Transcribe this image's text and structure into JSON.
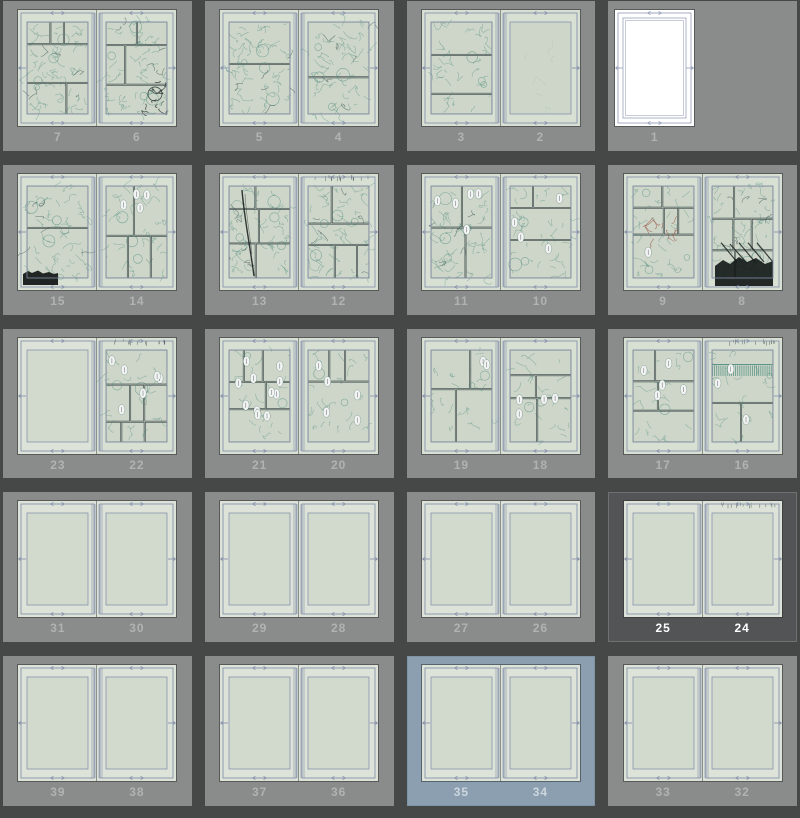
{
  "view": {
    "name": "page-manager-thumbnail-grid",
    "columns": 4,
    "rows": 5
  },
  "colors": {
    "background_gap": "#464848",
    "cell_bg": "#8a8c8c",
    "cell_selected_bg": "#525456",
    "cell_selected_border": "#6e7071",
    "cell_highlight_bg": "#8b9fb1",
    "paper_blank": "#dde3d8",
    "paper_sketch": "#d8e0d3",
    "paper_white": "#ffffff",
    "guide": "#8893ac",
    "guide_white": "#9aa3bd",
    "panel_stroke": "#455052",
    "sketch_teal": "#4b8f81",
    "sketch_dark": "#2f4a4a",
    "ink_black": "#101414",
    "ink_red": "#9b4f3c",
    "fold_line": "#3f4443",
    "page_number": "#b1b3b3",
    "page_number_selected": "#ffffff",
    "page_number_highlight": "#cdd6dd"
  },
  "spreads": [
    {
      "state": "normal",
      "pages": [
        {
          "num": "7",
          "content": "sketch",
          "density": "dense"
        },
        {
          "num": "6",
          "content": "sketch",
          "density": "dense",
          "dark_marks": true
        }
      ]
    },
    {
      "state": "normal",
      "pages": [
        {
          "num": "5",
          "content": "sketch",
          "density": "dense"
        },
        {
          "num": "4",
          "content": "sketch",
          "density": "dense"
        }
      ]
    },
    {
      "state": "normal",
      "pages": [
        {
          "num": "3",
          "content": "sketch",
          "density": "medium"
        },
        {
          "num": "2",
          "content": "sketch",
          "density": "faint"
        }
      ]
    },
    {
      "state": "normal",
      "pages": [
        {
          "num": "1",
          "content": "white"
        }
      ]
    },
    {
      "state": "normal",
      "pages": [
        {
          "num": "15",
          "content": "sketch",
          "density": "dense",
          "black_blob": "bottom-left"
        },
        {
          "num": "14",
          "content": "sketch",
          "density": "medium",
          "balloons": 4
        }
      ]
    },
    {
      "state": "normal",
      "pages": [
        {
          "num": "13",
          "content": "sketch",
          "density": "dense",
          "black_stroke": true
        },
        {
          "num": "12",
          "content": "sketch",
          "density": "dense",
          "top_scribbles": true
        }
      ]
    },
    {
      "state": "normal",
      "pages": [
        {
          "num": "11",
          "content": "sketch",
          "density": "dense",
          "balloons": 5
        },
        {
          "num": "10",
          "content": "sketch",
          "density": "medium",
          "balloons": 4
        }
      ]
    },
    {
      "state": "normal",
      "pages": [
        {
          "num": "9",
          "content": "sketch",
          "density": "medium",
          "red_marks": true,
          "balloons": 1
        },
        {
          "num": "8",
          "content": "sketch",
          "density": "dense",
          "black_blob": "bottom"
        }
      ]
    },
    {
      "state": "normal",
      "pages": [
        {
          "num": "23",
          "content": "blank"
        },
        {
          "num": "22",
          "content": "sketch",
          "density": "light",
          "balloons": 6,
          "top_scribbles": true
        }
      ]
    },
    {
      "state": "normal",
      "pages": [
        {
          "num": "21",
          "content": "sketch",
          "density": "light",
          "balloons": 11
        },
        {
          "num": "20",
          "content": "sketch",
          "density": "light",
          "balloons": 5
        }
      ]
    },
    {
      "state": "normal",
      "pages": [
        {
          "num": "19",
          "content": "sketch",
          "density": "light",
          "balloons": 2
        },
        {
          "num": "18",
          "content": "sketch",
          "density": "light",
          "balloons": 4
        }
      ]
    },
    {
      "state": "normal",
      "pages": [
        {
          "num": "17",
          "content": "sketch",
          "density": "light",
          "balloons": 5
        },
        {
          "num": "16",
          "content": "sketch",
          "density": "light",
          "balloons": 3,
          "stripes": true,
          "top_scribbles": true
        }
      ]
    },
    {
      "state": "normal",
      "pages": [
        {
          "num": "31",
          "content": "blank"
        },
        {
          "num": "30",
          "content": "blank"
        }
      ]
    },
    {
      "state": "normal",
      "pages": [
        {
          "num": "29",
          "content": "blank"
        },
        {
          "num": "28",
          "content": "blank"
        }
      ]
    },
    {
      "state": "normal",
      "pages": [
        {
          "num": "27",
          "content": "blank"
        },
        {
          "num": "26",
          "content": "blank"
        }
      ]
    },
    {
      "state": "selected",
      "pages": [
        {
          "num": "25",
          "content": "blank"
        },
        {
          "num": "24",
          "content": "blank",
          "top_scribbles": true
        }
      ]
    },
    {
      "state": "normal",
      "pages": [
        {
          "num": "39",
          "content": "blank"
        },
        {
          "num": "38",
          "content": "blank"
        }
      ]
    },
    {
      "state": "normal",
      "pages": [
        {
          "num": "37",
          "content": "blank"
        },
        {
          "num": "36",
          "content": "blank"
        }
      ]
    },
    {
      "state": "highlighted",
      "pages": [
        {
          "num": "35",
          "content": "blank"
        },
        {
          "num": "34",
          "content": "blank"
        }
      ]
    },
    {
      "state": "normal",
      "pages": [
        {
          "num": "33",
          "content": "blank"
        },
        {
          "num": "32",
          "content": "blank"
        }
      ]
    }
  ]
}
